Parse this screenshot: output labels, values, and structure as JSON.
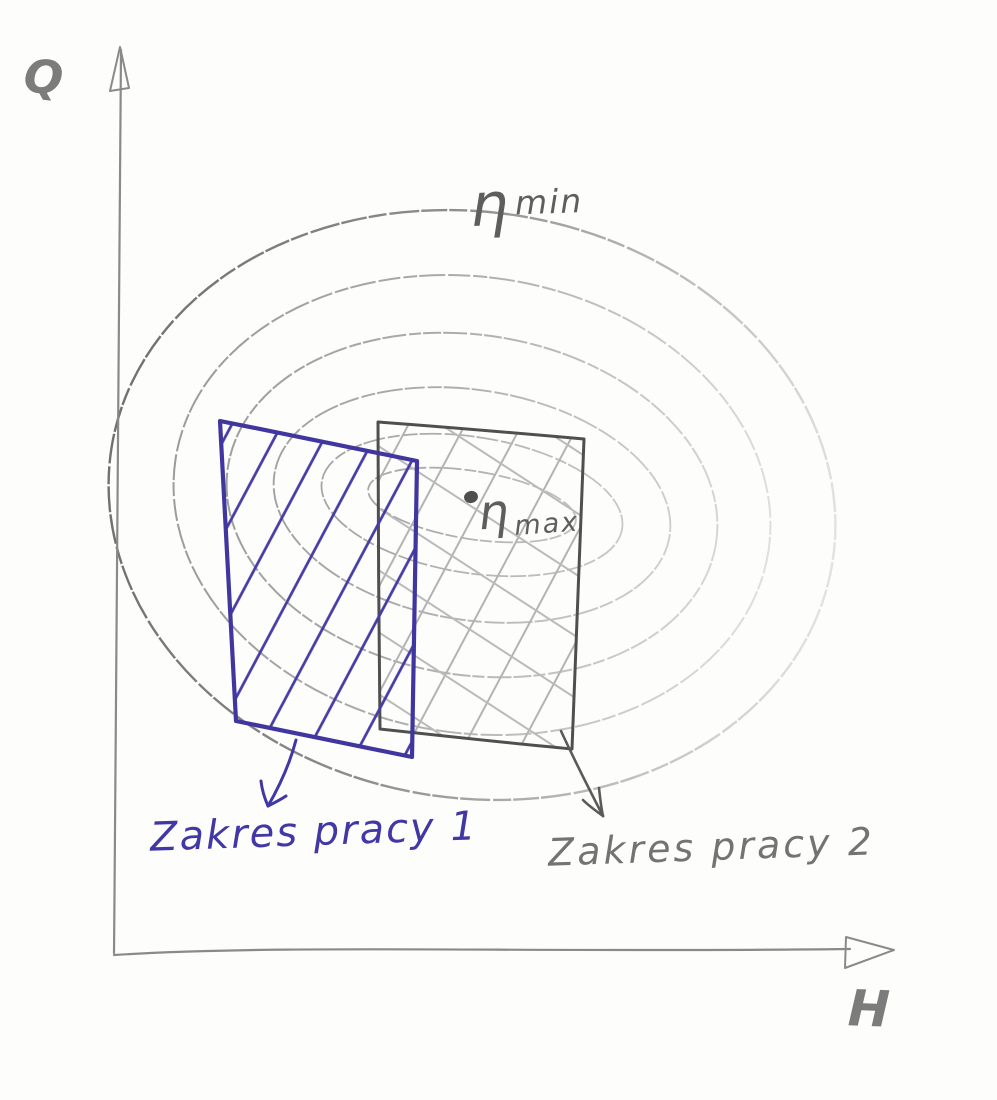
{
  "axes": {
    "y_label": "Q",
    "x_label": "H"
  },
  "contours": {
    "level_count": 6,
    "min_label": {
      "symbol": "η",
      "suffix": "min"
    },
    "max_label": {
      "symbol": "η",
      "suffix": "max"
    },
    "best_efficiency_point": "dot left of η max"
  },
  "regions": {
    "region1": {
      "label": "Zakres pracy 1",
      "ink_color": "#4138a5",
      "hatch": "single-diagonal"
    },
    "region2": {
      "label": "Zakres pracy 2",
      "ink_color": "#737373",
      "hatch": "cross-diagonal"
    }
  },
  "colors": {
    "paper": "#fdfdfc",
    "pencil": "#8a8a8a",
    "pencil_dark": "#4f4f4f",
    "ink_blue": "#4138a5"
  }
}
